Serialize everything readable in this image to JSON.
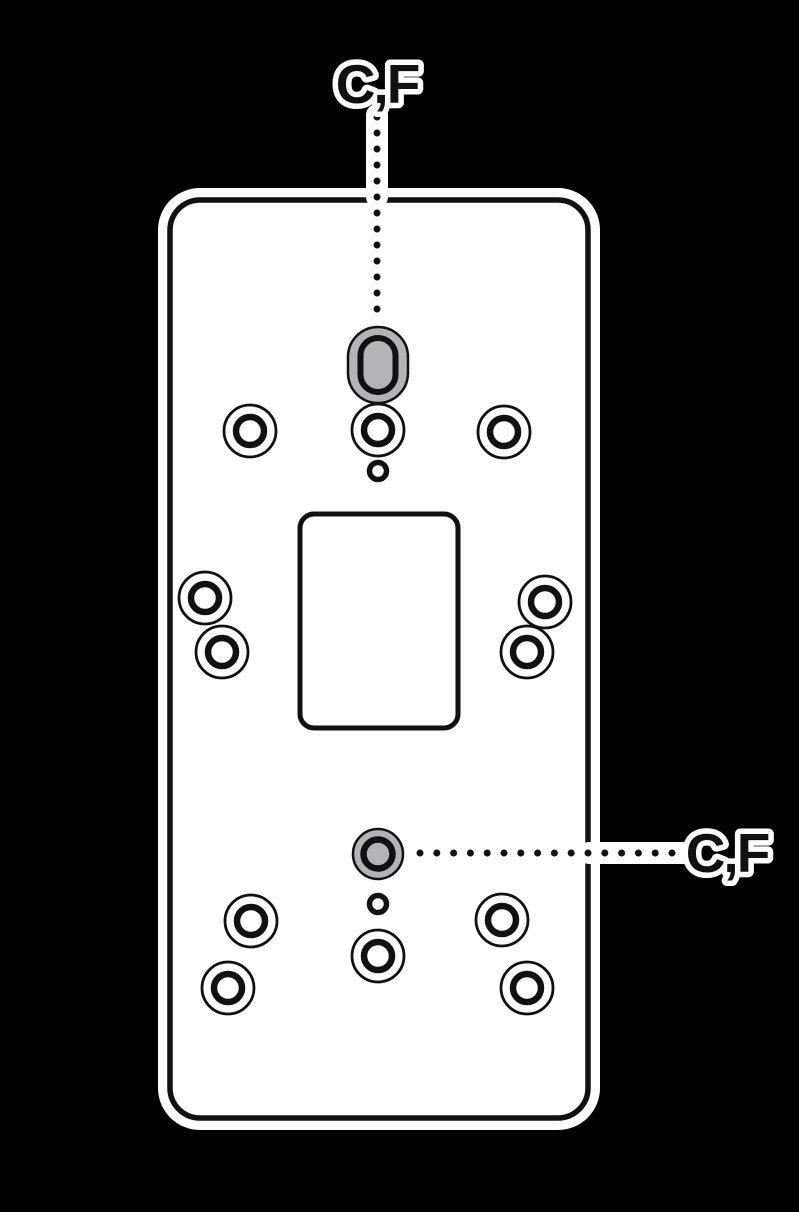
{
  "figure": {
    "type": "mounting-plate-installation-diagram",
    "background_color": "#000000",
    "plate_color": "#ffffff",
    "outline_color": "#111111",
    "highlight_color": "#b4b4b6",
    "callout_labels": {
      "top": "C,F",
      "bottom": "C,F"
    }
  },
  "plate": {
    "x": 170,
    "y": 200,
    "width": 418,
    "height": 918,
    "corner_radius": 30,
    "stroke_width": 5.5,
    "halo_width": 24
  },
  "slot": {
    "cx": 378,
    "cy": 365,
    "outer_width": 60,
    "outer_height": 76,
    "inner_width": 35,
    "inner_height": 54,
    "inner_stroke": 6,
    "outer_stroke": 2.5
  },
  "cutout": {
    "x": 300,
    "y": 514,
    "width": 158,
    "height": 214,
    "corner_radius": 14,
    "stroke_width": 5
  },
  "holes": [
    {
      "name": "top-left-screw-hole",
      "type": "double",
      "cx": 250,
      "cy": 431
    },
    {
      "name": "top-center-screw-hole",
      "type": "double",
      "cx": 378,
      "cy": 430
    },
    {
      "name": "top-right-screw-hole",
      "type": "double",
      "cx": 504,
      "cy": 432
    },
    {
      "name": "top-pilot-hole",
      "type": "small",
      "cx": 378,
      "cy": 471
    },
    {
      "name": "mid-left-outer-screw-hole",
      "type": "double",
      "cx": 205,
      "cy": 598
    },
    {
      "name": "mid-left-inner-screw-hole",
      "type": "double",
      "cx": 222,
      "cy": 652
    },
    {
      "name": "mid-right-outer-screw-hole",
      "type": "double",
      "cx": 545,
      "cy": 602
    },
    {
      "name": "mid-right-inner-screw-hole",
      "type": "double",
      "cx": 527,
      "cy": 652
    },
    {
      "name": "highlighted-screw-hole",
      "type": "highlight",
      "cx": 378,
      "cy": 854
    },
    {
      "name": "bottom-pilot-hole",
      "type": "small",
      "cx": 378,
      "cy": 904
    },
    {
      "name": "bottom-center-screw-hole",
      "type": "double",
      "cx": 378,
      "cy": 956
    },
    {
      "name": "bottom-left-inner-screw-hole",
      "type": "double",
      "cx": 251,
      "cy": 921
    },
    {
      "name": "bottom-left-outer-screw-hole",
      "type": "double",
      "cx": 228,
      "cy": 988
    },
    {
      "name": "bottom-right-inner-screw-hole",
      "type": "double",
      "cx": 502,
      "cy": 920
    },
    {
      "name": "bottom-right-outer-screw-hole",
      "type": "double",
      "cx": 527,
      "cy": 988
    }
  ],
  "hole_styles": {
    "double": {
      "outer_r": 26,
      "outer_stroke": 2.8,
      "inner_r": 14,
      "inner_stroke": 6.5
    },
    "small": {
      "r": 8.5,
      "stroke": 5.5
    },
    "highlight": {
      "outer_r": 25,
      "outer_stroke": 2.5,
      "inner_r": 14.5,
      "inner_stroke": 6.5
    }
  },
  "callout_dots": {
    "top": {
      "x": 377,
      "y_start": 117,
      "step": 16,
      "count": 13,
      "dot_r": 3.5
    },
    "bottom": {
      "y": 853,
      "x_start": 420,
      "step": 16.8,
      "count": 16,
      "dot_r": 3.5
    }
  }
}
